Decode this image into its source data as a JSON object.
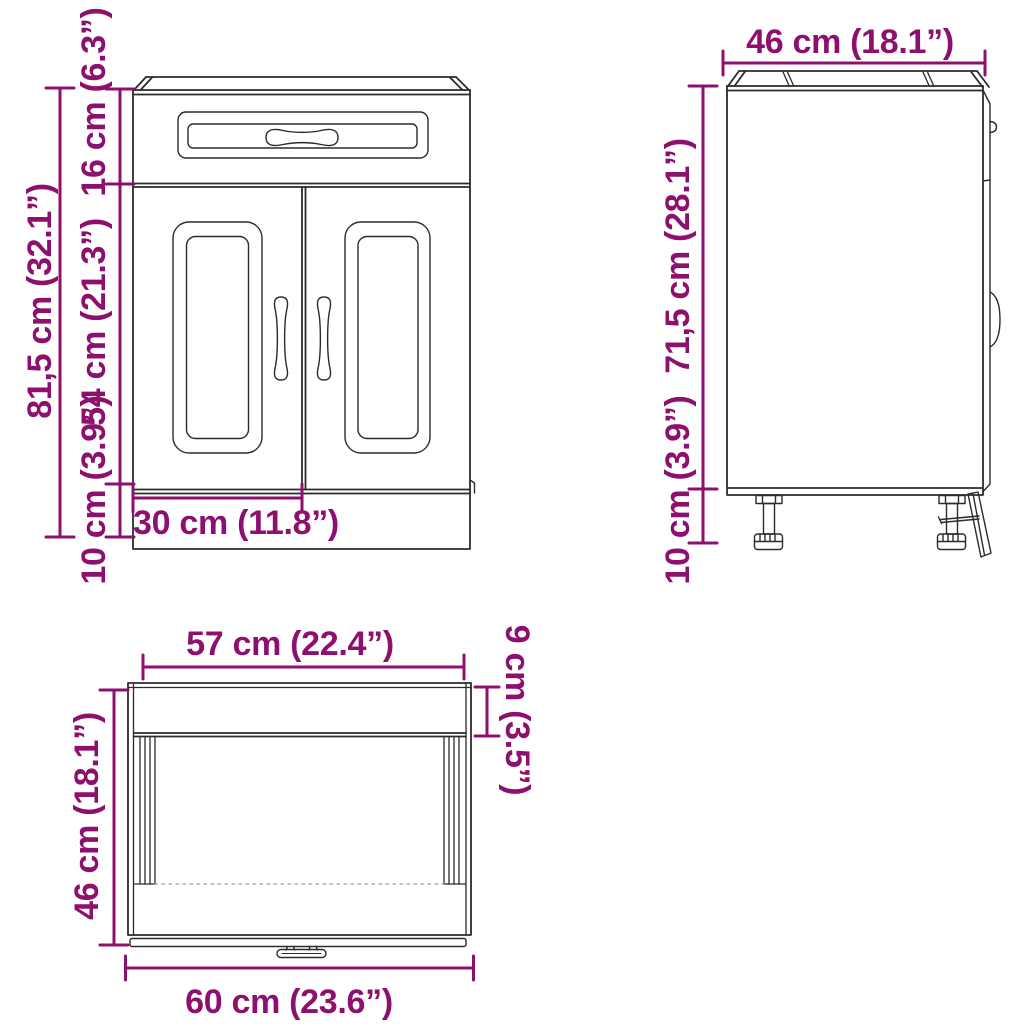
{
  "colors": {
    "dimension": "#8E106E",
    "outline": "#2b2b2b",
    "hidden_line": "#9a9a9a",
    "background": "#ffffff"
  },
  "views": {
    "front": {
      "dims": {
        "total_height": "81,5 cm (32.1”)",
        "drawer_height": "16 cm (6.3”)",
        "door_height": "54 cm (21.3”)",
        "base_height": "10 cm (3.9”)",
        "door_width": "30 cm (11.8”)"
      }
    },
    "side": {
      "dims": {
        "depth": "46 cm (18.1”)",
        "body_height": "71,5 cm (28.1”)",
        "leg_height": "10 cm (3.9”)"
      }
    },
    "top": {
      "dims": {
        "inner_width": "57 cm (22.4”)",
        "top_rail_depth": "9 cm (3.5”)",
        "depth": "46 cm (18.1”)",
        "total_width": "60 cm (23.6”)"
      }
    }
  }
}
